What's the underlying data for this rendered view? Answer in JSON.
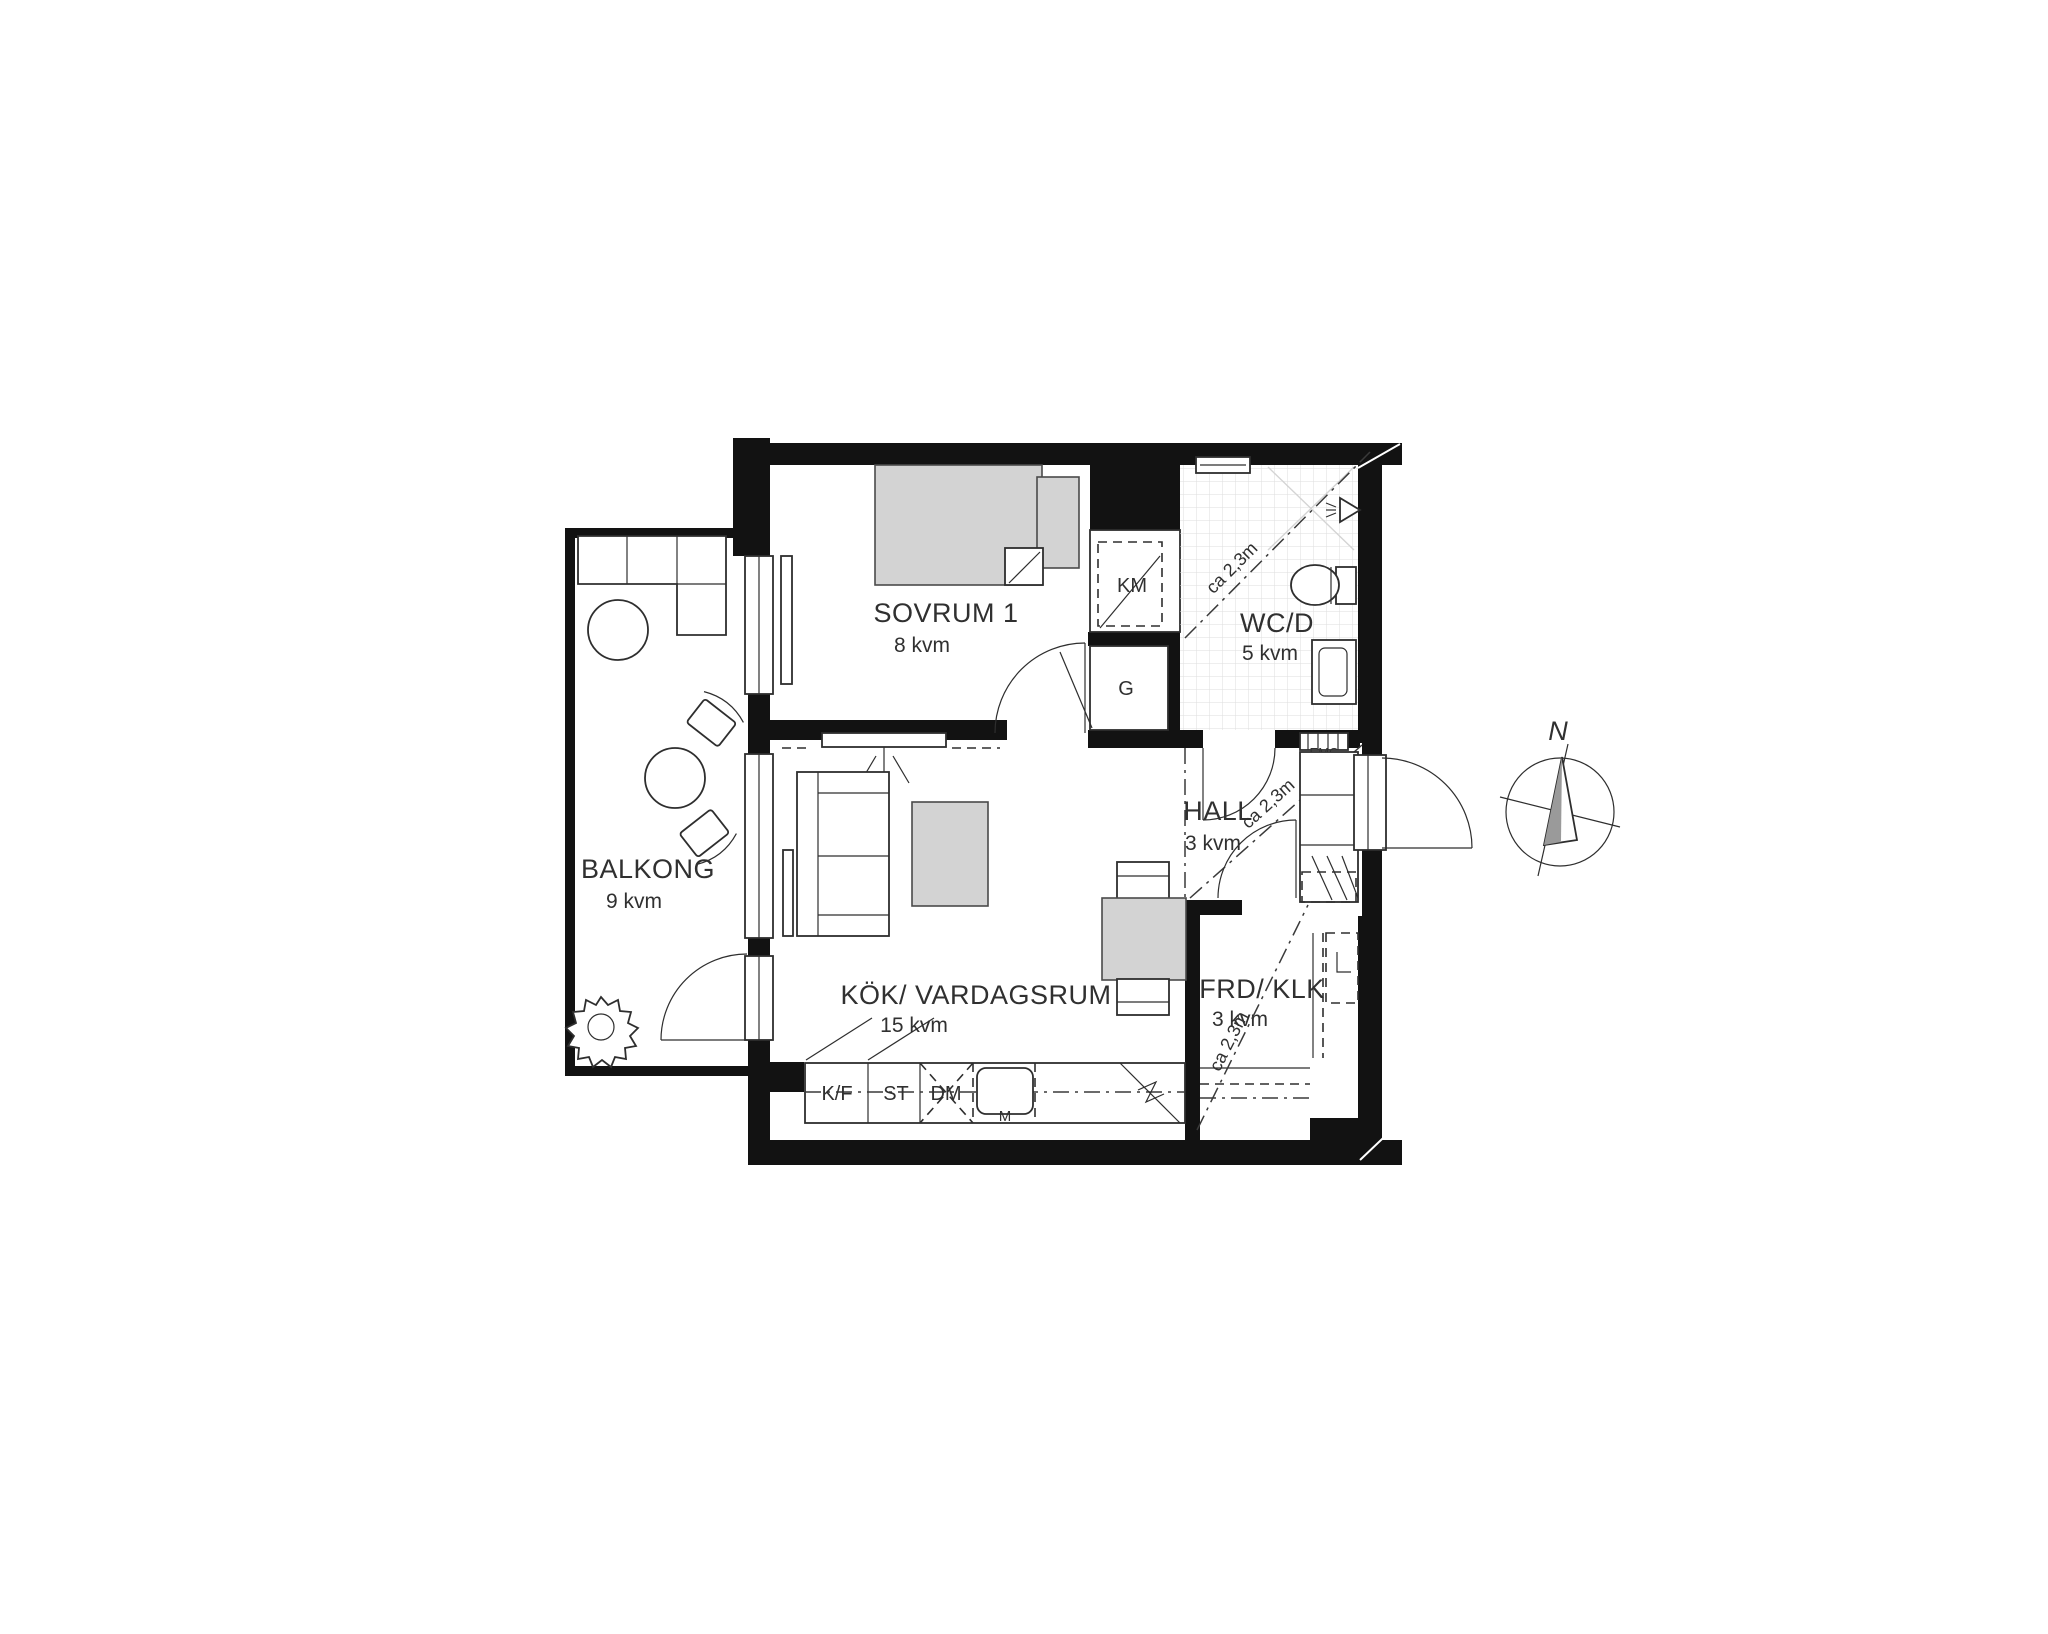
{
  "rooms": {
    "sovrum": {
      "name": "SOVRUM 1",
      "area": "8 kvm"
    },
    "wc": {
      "name": "WC/D",
      "area": "5 kvm"
    },
    "hall": {
      "name": "HALL",
      "area": "3 kvm"
    },
    "kok": {
      "name": "KÖK/ VARDAGSRUM",
      "area": "15 kvm"
    },
    "frd": {
      "name": "FRD/ KLK",
      "area": "3 kvm"
    },
    "balkong": {
      "name": "BALKONG",
      "area": "9 kvm"
    }
  },
  "fixtures": {
    "km": "KM",
    "g": "G",
    "kf": "K/F",
    "st": "ST",
    "dm": "DM",
    "m": "M",
    "emc": "EMC"
  },
  "dimensions": {
    "wc": "ca 2,3m",
    "hall": "ca 2,3m",
    "frd": "ca 2,3m"
  },
  "compass": {
    "north": "N"
  },
  "colors": {
    "wall": "#121212",
    "balcony_wall": "#121212",
    "furniture_fill": "#d3d3d3",
    "line": "#2e2e2e",
    "tile": "#dedede",
    "background": "#ffffff"
  }
}
